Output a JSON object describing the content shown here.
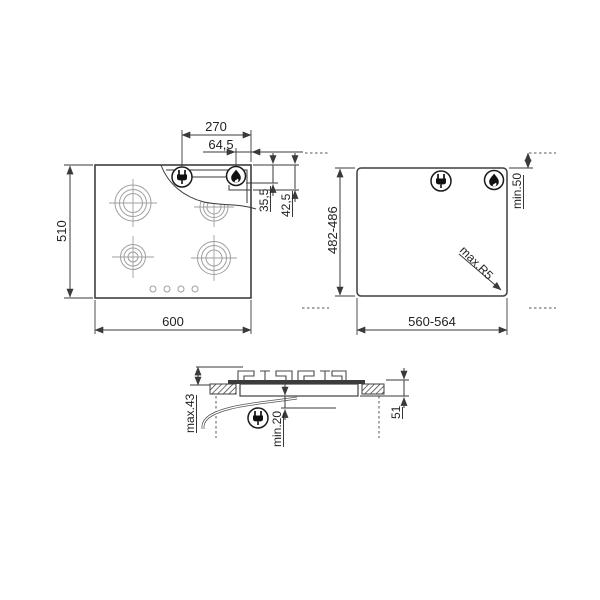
{
  "diagram": {
    "top_view": {
      "width_600": "600",
      "height_510": "510",
      "dim_270": "270",
      "dim_64_5": "64,5",
      "dim_35_5": "35,5",
      "dim_42_5": "42,5"
    },
    "cutout_view": {
      "width_560_564": "560-564",
      "depth_482_486": "482-486",
      "rear_clearance": "min.50",
      "corner_radius": "max.R5"
    },
    "section_view": {
      "height_above": "max.43",
      "clearance_below": "min.20",
      "install_depth": "51"
    },
    "icons": {
      "plug": "power-plug",
      "flame": "gas-flame"
    },
    "colors": {
      "line": "#3a3a3a",
      "light_line": "#9f9f9f",
      "icon": "#111111",
      "background": "#ffffff"
    }
  }
}
